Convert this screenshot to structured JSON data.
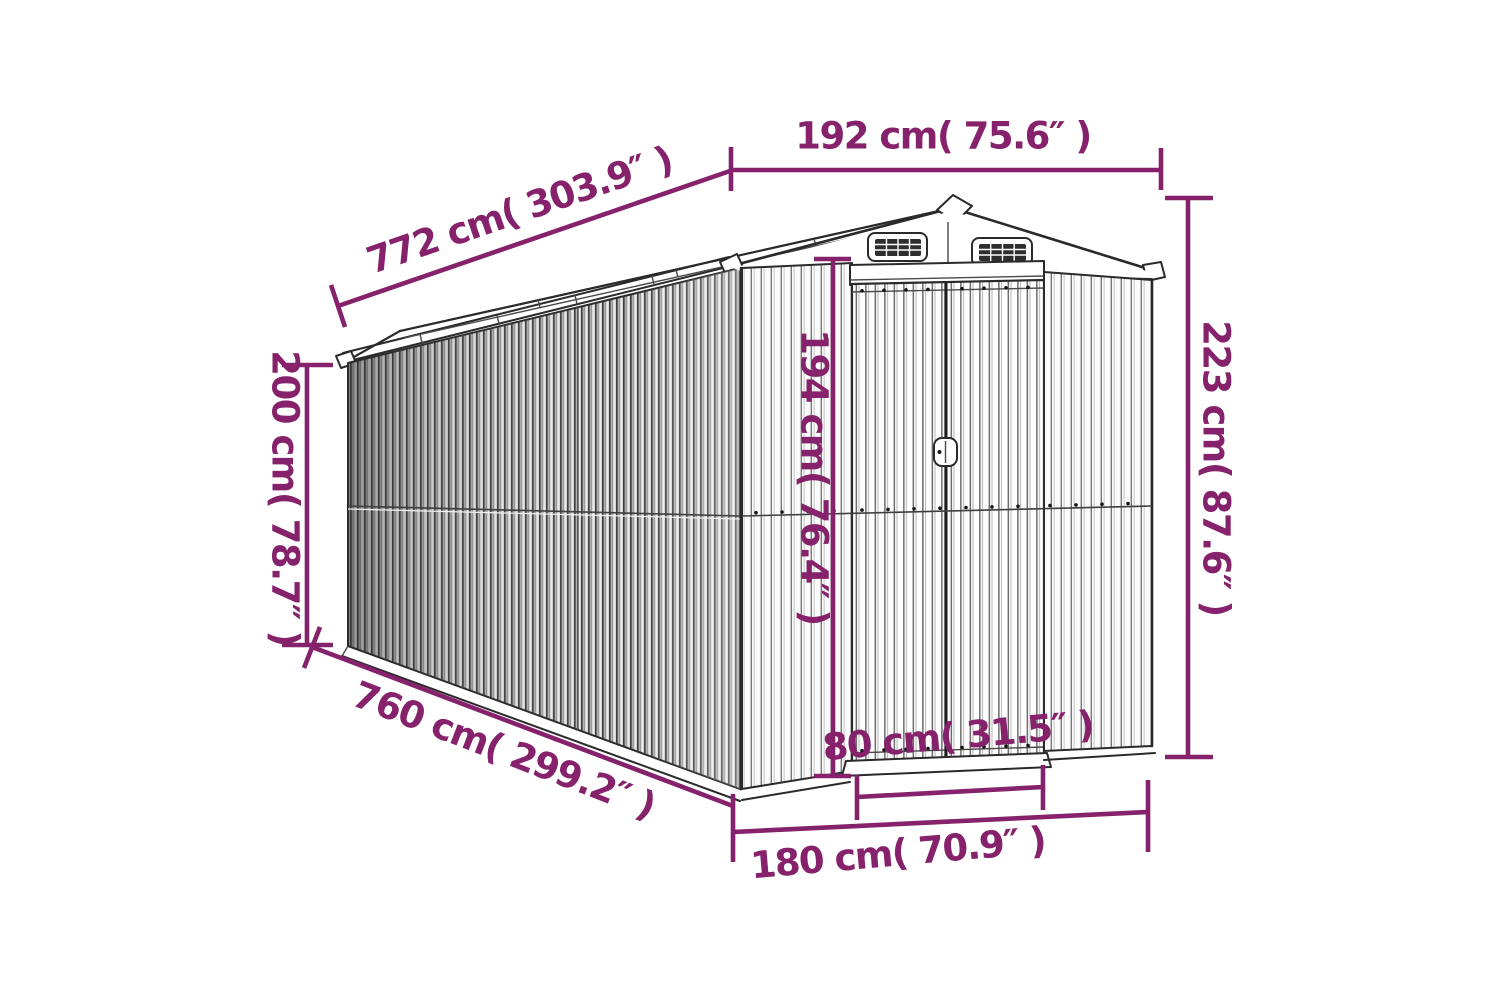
{
  "figure": {
    "type": "product-dimension-diagram",
    "subject": "metal garden shed line drawing, perspective view with gable roof, louver vents and double sliding doors",
    "background_color": "#ffffff",
    "accent_color": "#86216b",
    "drawing_line_color": "#2a2a2a",
    "dimensions": {
      "roof_length": {
        "label": "772 cm( 303.9″ )",
        "cm": 772,
        "inches": 303.9
      },
      "roof_front_width": {
        "label": "192 cm( 75.6″ )",
        "cm": 192,
        "inches": 75.6
      },
      "total_height": {
        "label": "223 cm( 87.6″ )",
        "cm": 223,
        "inches": 87.6
      },
      "side_wall_height": {
        "label": "200 cm( 78.7″ )",
        "cm": 200,
        "inches": 78.7
      },
      "door_height": {
        "label": "194 cm( 76.4″ )",
        "cm": 194,
        "inches": 76.4
      },
      "base_length": {
        "label": "760 cm( 299.2″ )",
        "cm": 760,
        "inches": 299.2
      },
      "door_width": {
        "label": "80 cm( 31.5″ )",
        "cm": 80,
        "inches": 31.5
      },
      "base_front_width": {
        "label": "180 cm( 70.9″ )",
        "cm": 180,
        "inches": 70.9
      }
    }
  }
}
